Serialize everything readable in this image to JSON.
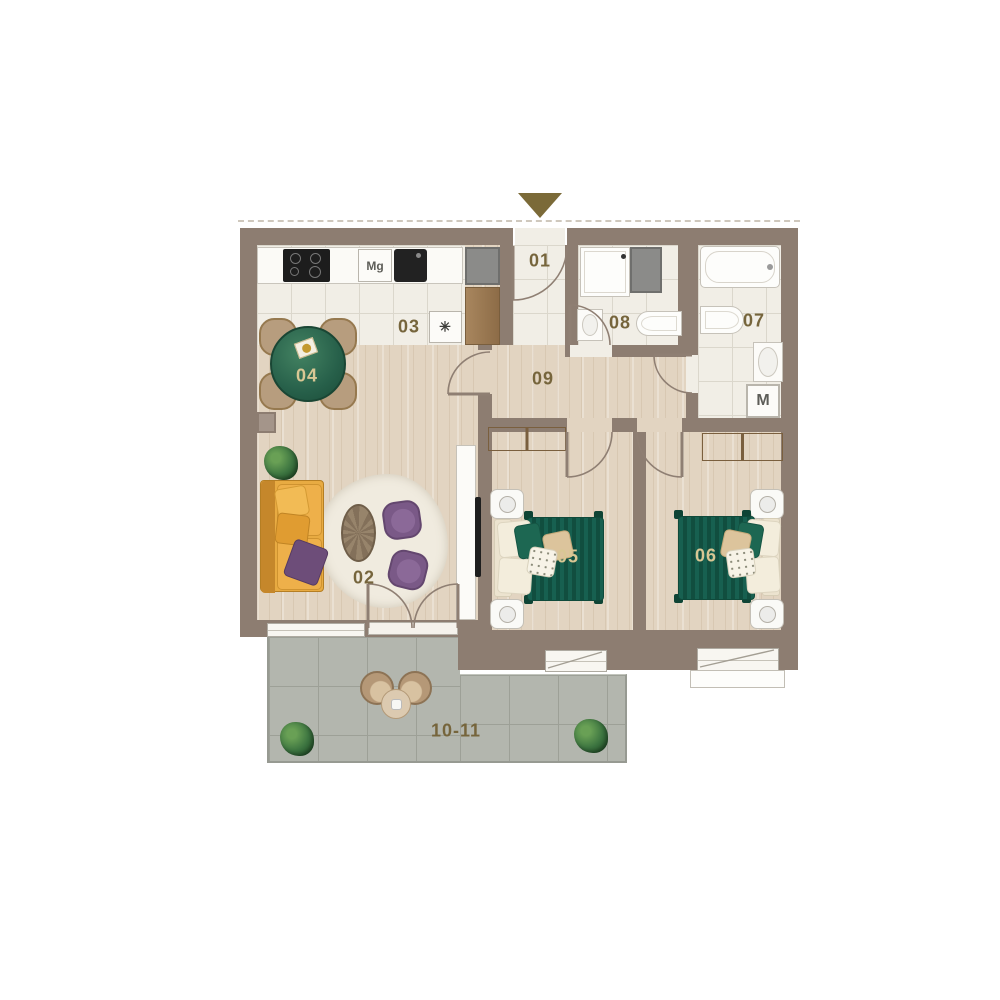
{
  "floor_plan": {
    "room_labels": {
      "entry": "01",
      "living_room": "02",
      "kitchen": "03",
      "dining": "04",
      "bedroom_1": "05",
      "bedroom_2": "06",
      "bathroom": "07",
      "toilet_room": "08",
      "hallway": "09",
      "balcony": "10-11"
    },
    "appliance_labels": {
      "microwave": "Mg",
      "dishwasher": "✳",
      "washing_machine": "M"
    },
    "colors": {
      "wall": "#8d7d71",
      "wood_floor": "#e2d4c1",
      "tile_floor": "#f1eee6",
      "balcony_tile": "#b3b6ae",
      "label": "#76653c",
      "label_on_green": "#d9c794",
      "bed_green": "#176050",
      "sofa_yellow": "#e2a23c",
      "armchair_purple": "#7a5987",
      "entrance_arrow": "#7b6a38"
    }
  }
}
